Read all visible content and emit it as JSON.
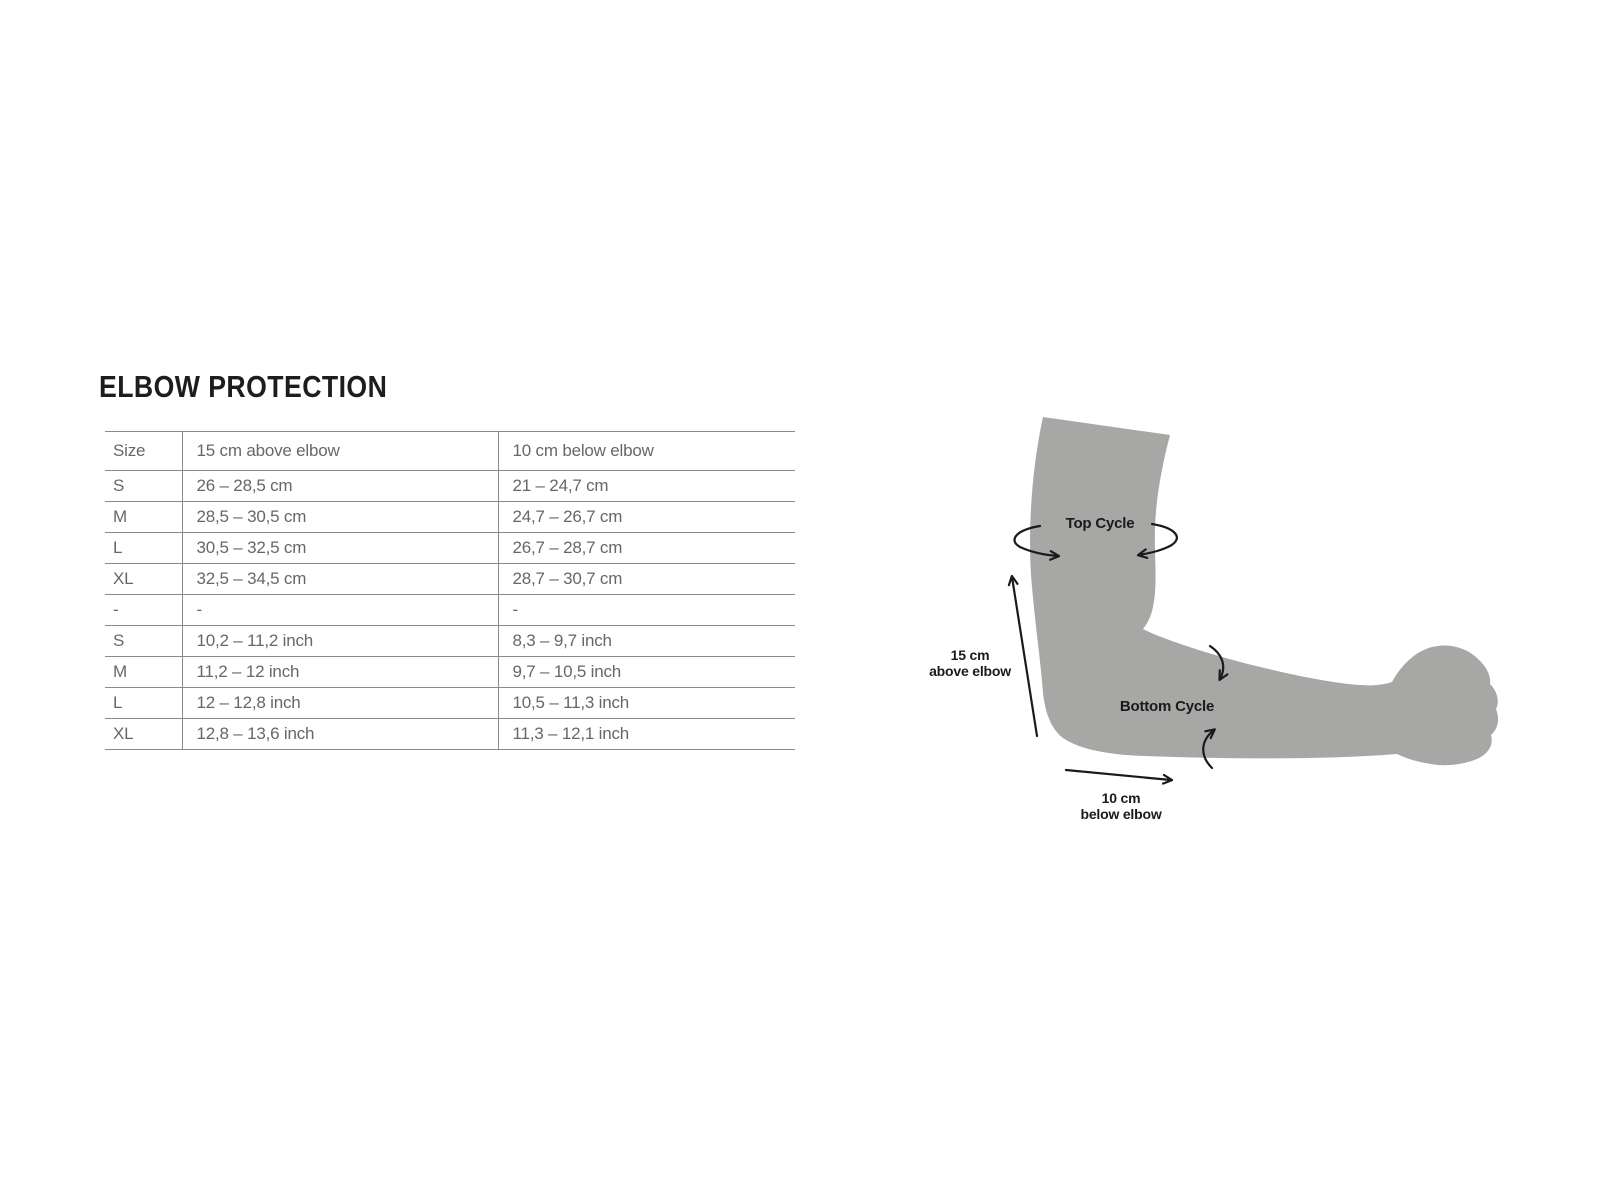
{
  "title": "ELBOW PROTECTION",
  "table": {
    "columns": [
      "Size",
      "15 cm above elbow",
      "10 cm below elbow"
    ],
    "rows": [
      [
        "S",
        "26 – 28,5 cm",
        "21 – 24,7 cm"
      ],
      [
        "M",
        "28,5 – 30,5 cm",
        "24,7 – 26,7 cm"
      ],
      [
        "L",
        "30,5 – 32,5 cm",
        "26,7 – 28,7 cm"
      ],
      [
        "XL",
        "32,5 – 34,5 cm",
        "28,7 – 30,7 cm"
      ],
      [
        "-",
        "-",
        "-"
      ],
      [
        "S",
        "10,2 – 11,2 inch",
        "8,3 – 9,7 inch"
      ],
      [
        "M",
        "11,2 – 12 inch",
        "9,7 – 10,5 inch"
      ],
      [
        "L",
        "12 – 12,8 inch",
        "10,5 – 11,3 inch"
      ],
      [
        "XL",
        "12,8 – 13,6 inch",
        "11,3 – 12,1 inch"
      ]
    ]
  },
  "diagram": {
    "top_cycle": "Top Cycle",
    "bottom_cycle": "Bottom Cycle",
    "above_elbow": {
      "line1": "15 cm",
      "line2": "above elbow"
    },
    "below_elbow": {
      "line1": "10 cm",
      "line2": "below elbow"
    }
  },
  "colors": {
    "title_text": "#1d1d1b",
    "table_text": "#67676a",
    "table_border": "#8a8a8a",
    "arm_fill": "#a7a7a6",
    "annotation": "#1a1a1a",
    "background": "#ffffff"
  }
}
